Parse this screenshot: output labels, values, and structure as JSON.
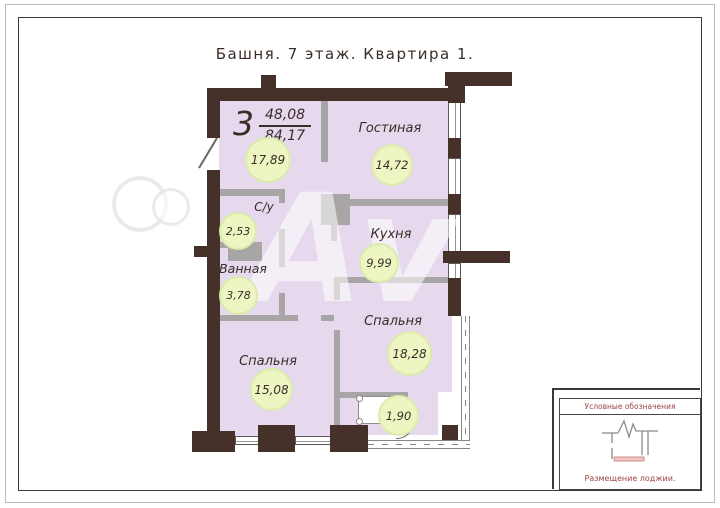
{
  "page": {
    "title": "Башня. 7 этаж. Квартира 1.",
    "watermark": "Avito"
  },
  "apartment": {
    "rooms_count": "3",
    "upper_area": "48,08",
    "lower_area": "84,17"
  },
  "rooms": {
    "hall": {
      "area": "17,89"
    },
    "living": {
      "label": "Гостиная",
      "area": "14,72"
    },
    "kitchen": {
      "label": "Кухня",
      "area": "9,99"
    },
    "wc": {
      "label": "С/у",
      "area": "2,53"
    },
    "bath": {
      "label": "Ванная",
      "area": "3,78"
    },
    "bedroom_big": {
      "label": "Спальня",
      "area": "18,28"
    },
    "bedroom_small": {
      "label": "Спальня",
      "area": "15,08"
    },
    "loggia": {
      "area": "1,90"
    }
  },
  "legend": {
    "title": "Условные обозначения",
    "caption": "Размещение лоджии."
  },
  "colors": {
    "wall": "#46302a",
    "room": "#e6d9ee",
    "part": "#a8a5a6",
    "badge": "#edf5c3",
    "badgeB": "#dcebab",
    "ink": "#3a2d26",
    "lgd": "#9c4343"
  }
}
